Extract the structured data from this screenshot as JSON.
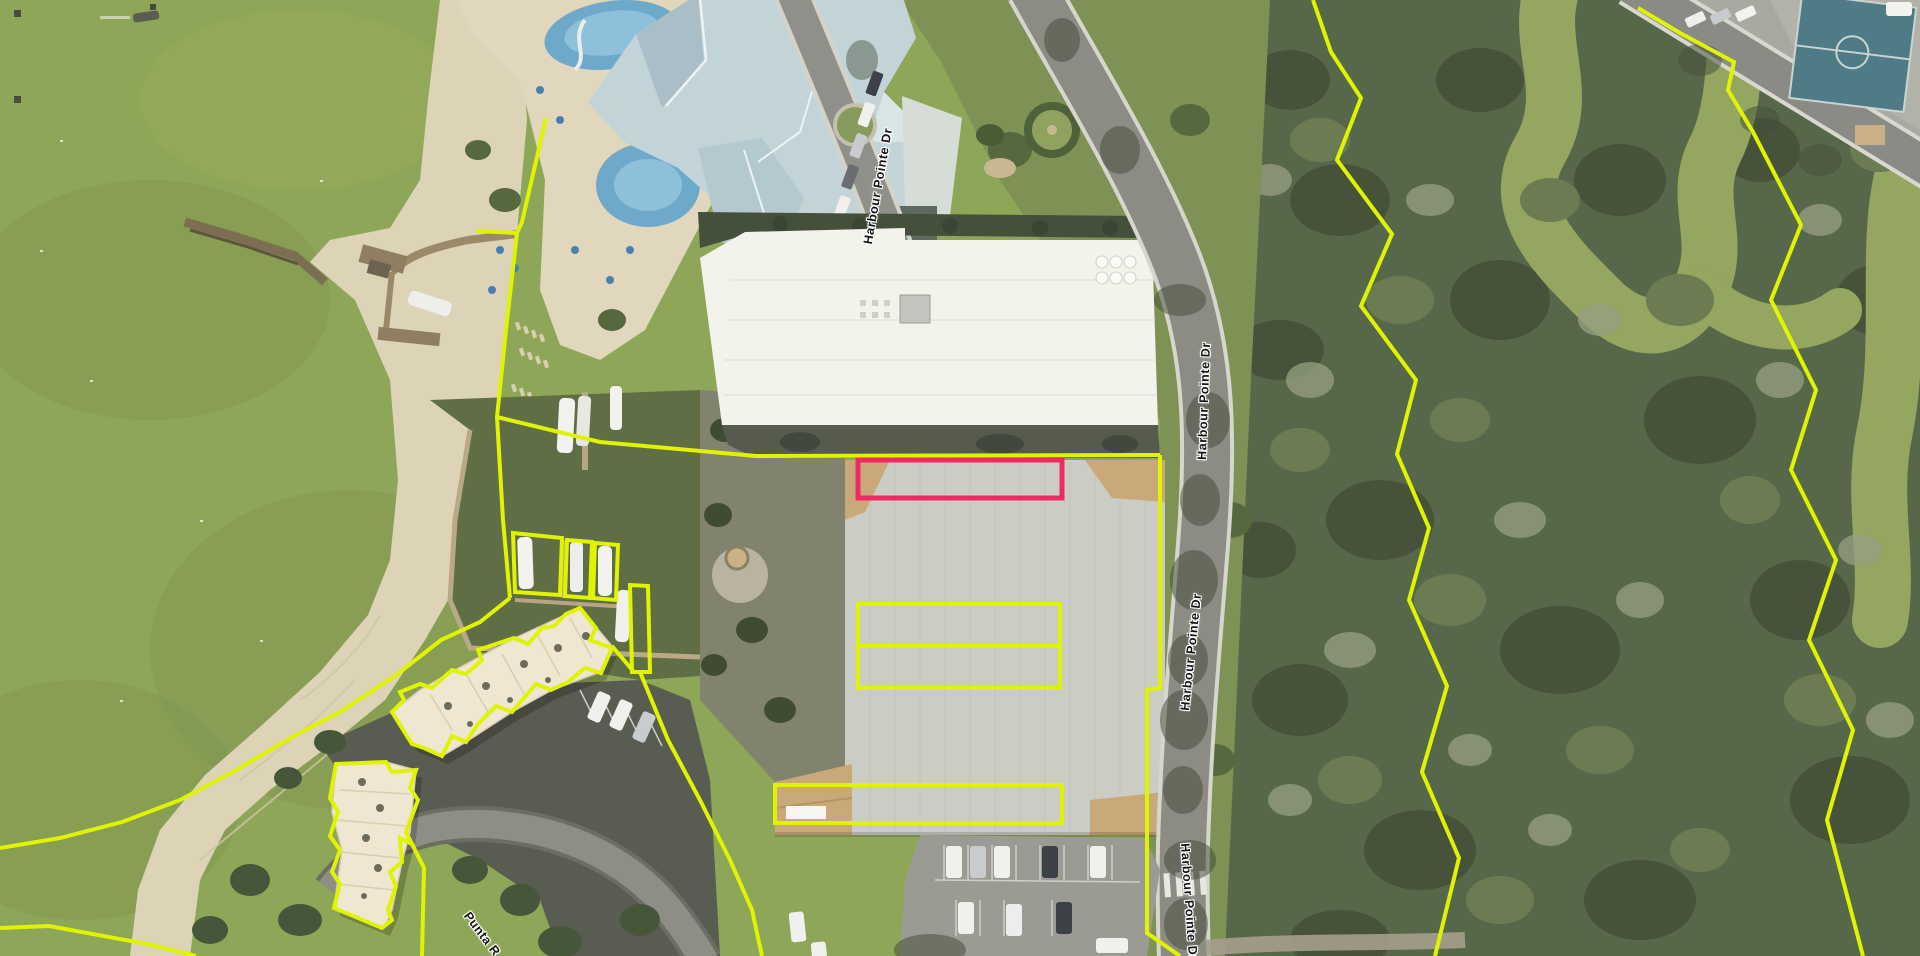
{
  "map": {
    "type": "aerial-parcel-map",
    "description": "Aerial imagery with parcel boundary overlay and one selected parcel highlighted"
  },
  "colors": {
    "parcel_line": "#e0f402",
    "selected_parcel": "#ee2a62",
    "label_text": "#161616",
    "label_halo": "#ffffff"
  },
  "road_labels": [
    {
      "id": "harbour-pointe-dr-1",
      "text": "Harbour Pointe Dr",
      "x": 878,
      "y": 186,
      "rotation": -80
    },
    {
      "id": "harbour-pointe-dr-2",
      "text": "Harbour Pointe Dr",
      "x": 1204,
      "y": 401,
      "rotation": -88
    },
    {
      "id": "harbour-pointe-dr-3",
      "text": "Harbour Pointe Dr",
      "x": 1191,
      "y": 652,
      "rotation": -84
    },
    {
      "id": "harbour-pointe-dr-4",
      "text": "Harbour Pointe Dr",
      "x": 1189,
      "y": 902,
      "rotation": 86
    },
    {
      "id": "punta-rd",
      "text": "Punta R",
      "x": 482,
      "y": 934,
      "rotation": 53
    }
  ],
  "overlays": {
    "selected_parcel": {
      "shape": "rect",
      "x": 858,
      "y": 460,
      "width": 204,
      "height": 38,
      "stroke_width": 5
    },
    "parcel_rects": [
      {
        "name": "parcel-rect-mid-1",
        "x": 858,
        "y": 604,
        "width": 202,
        "height": 42
      },
      {
        "name": "parcel-rect-mid-2",
        "x": 858,
        "y": 646,
        "width": 202,
        "height": 42
      },
      {
        "name": "parcel-rect-south",
        "x": 775,
        "y": 785,
        "width": 287,
        "height": 38
      }
    ],
    "parcel_polylines": [
      {
        "name": "shore-boundary",
        "closed": false,
        "points": "546,118 522,222 517,233 506,330 497,417 503,520 510,598"
      },
      {
        "name": "pier-tick",
        "closed": false,
        "points": "476,231 517,233"
      },
      {
        "name": "marina-north-boundary",
        "closed": false,
        "points": "497,417 600,442 756,456 1160,455"
      },
      {
        "name": "warehouse-east-boundary",
        "closed": false,
        "points": "1160,455 1160,688 1147,690 1147,933 1180,956"
      },
      {
        "name": "forest-boundary-west",
        "closed": false,
        "points": "1313,0 1331,52 1361,98 1337,160 1392,234 1361,306 1416,380 1397,454 1429,528 1409,600 1447,686 1422,772 1459,858 1435,956"
      },
      {
        "name": "forest-boundary-east",
        "closed": false,
        "points": "1638,8 1680,33 1734,62 1728,90 1753,132 1801,225 1771,300 1816,390 1791,470 1836,560 1809,640 1853,730 1827,820 1863,956"
      },
      {
        "name": "beach-boundary",
        "closed": false,
        "points": "510,598 480,622 441,640 395,676 340,712 294,736 240,768 180,800 122,822 60,838 0,848"
      },
      {
        "name": "bottom-left-boundary",
        "closed": false,
        "points": "0,928 49,926 147,944 196,956"
      },
      {
        "name": "boat-slip-1",
        "closed": true,
        "points": "513,533 562,538 560,595 515,592"
      },
      {
        "name": "boat-slip-2",
        "closed": true,
        "points": "567,540 592,542 590,598 565,596"
      },
      {
        "name": "boat-slip-3",
        "closed": true,
        "points": "595,543 618,545 616,600 593,598"
      },
      {
        "name": "dock-parcel",
        "closed": true,
        "points": "630,585 648,586 650,672 632,672"
      },
      {
        "name": "condo-north-outline",
        "closed": true,
        "points": "392,712 404,700 400,692 420,684 432,688 452,670 466,674 482,660 478,650 514,638 528,644 542,628 554,626 566,614 580,608 596,628 590,640 612,648 601,673 585,668 568,682 551,690 536,684 512,712 496,706 478,724 466,742 452,736 442,756 424,748 412,744"
      },
      {
        "name": "condo-west-outline",
        "closed": true,
        "points": "336,764 386,762 392,772 416,770 410,788 418,800 406,832 412,844 400,838 402,862 390,872 396,886 388,910 392,920 382,928 334,908 340,884 332,872 340,850 330,836 338,812 330,798"
      },
      {
        "name": "condo-road-connector",
        "closed": false,
        "points": "612,646 634,672"
      },
      {
        "name": "parcel-south-boundary",
        "closed": false,
        "points": "640,672 668,740 700,800 730,860 752,910 762,956"
      },
      {
        "name": "condo-south-boundary",
        "closed": false,
        "points": "412,844 424,868 422,956"
      }
    ]
  }
}
